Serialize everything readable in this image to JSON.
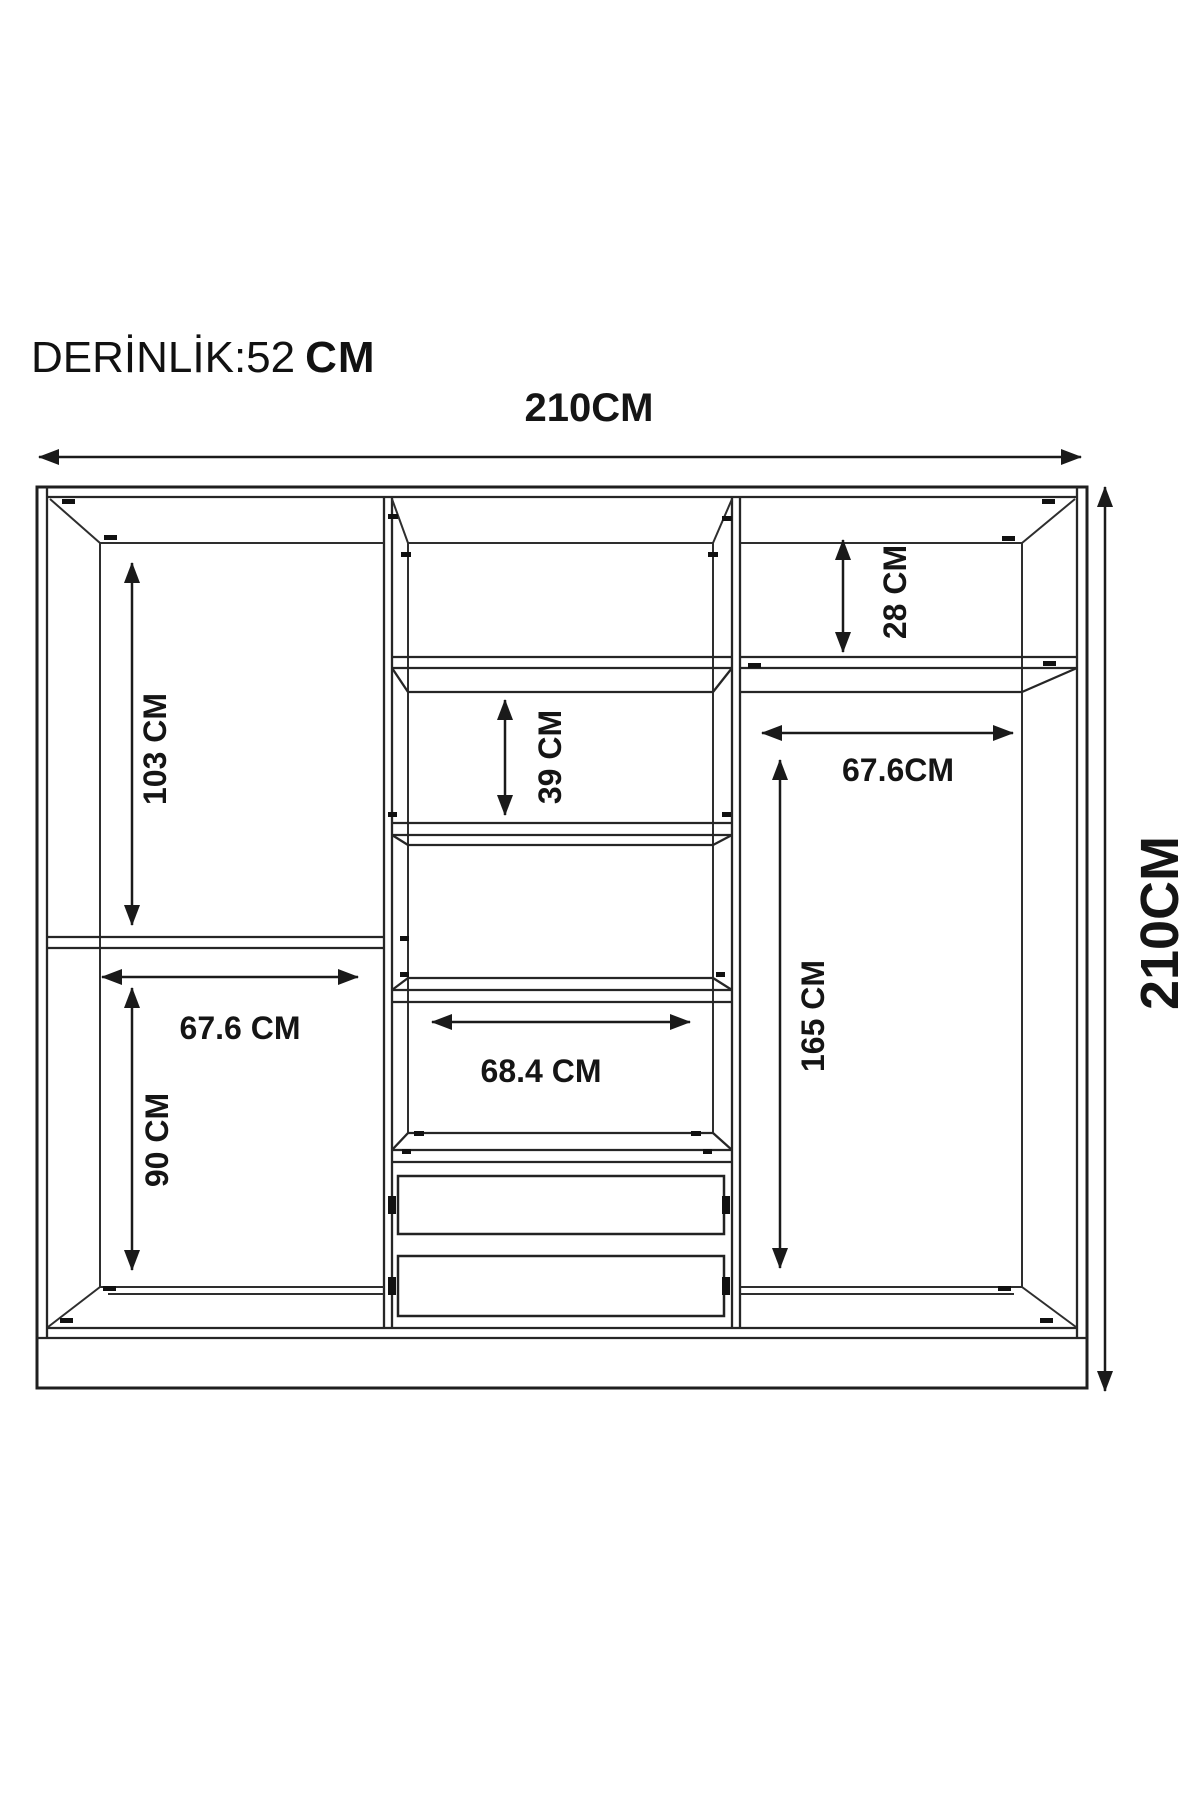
{
  "header": {
    "depth_label": "DERİNLİK:52",
    "depth_unit": "CM"
  },
  "dimensions": {
    "overall_width": "210CM",
    "overall_height": "210CM",
    "left_upper_height": "103 CM",
    "left_shelf_width": "67.6 CM",
    "left_lower_height": "90 CM",
    "middle_compartment_height": "39 CM",
    "middle_shelf_width": "68.4 CM",
    "right_top_height": "28 CM",
    "right_shelf_width": "67.6CM",
    "right_hanging_height": "165 CM"
  }
}
